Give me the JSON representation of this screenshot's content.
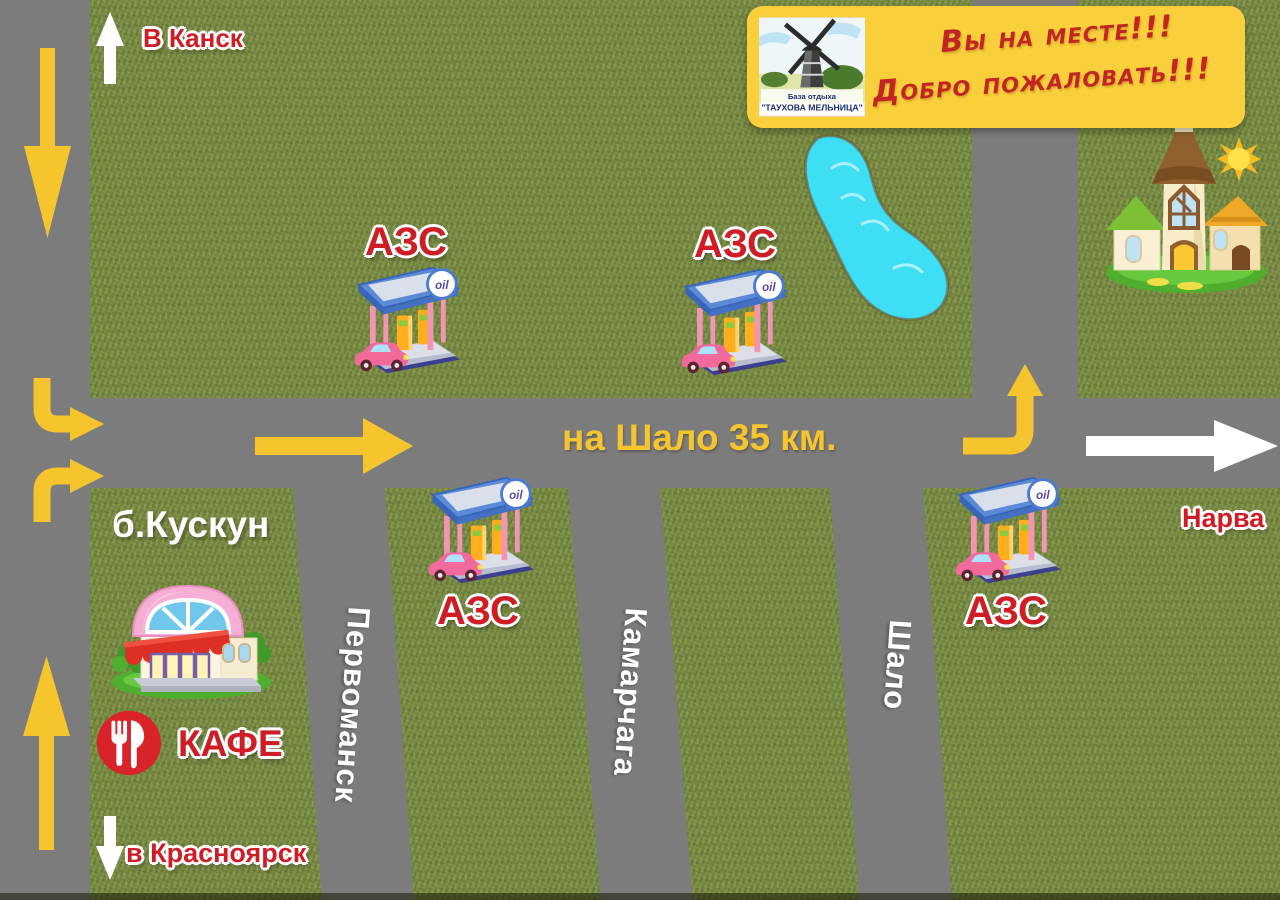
{
  "banner": {
    "line1": "Вы на месте!!!",
    "line2": "Добро пожаловать!!!",
    "logo_caption_top": "База отдыха",
    "logo_caption_bottom": "\"ТАУХОВА МЕЛЬНИЦА\""
  },
  "directions": {
    "north_label": "В Канск",
    "south_label": "в Красноярск",
    "east_route_label": "на Шало 35 км.",
    "east_village_label": "Нарва"
  },
  "places": {
    "village_left": "б.Кускун",
    "cafe_label": "КАФЕ",
    "gas_station_label": "АЗС",
    "oil_sign": "oil"
  },
  "side_roads": [
    {
      "name": "Первоманск"
    },
    {
      "name": "Камарчага"
    },
    {
      "name": "Шало"
    }
  ],
  "colors": {
    "grass": "#7a8c42",
    "road": "#7c7c7c",
    "route_arrow_yellow": "#f6c52e",
    "banner_yellow": "#f9d03b",
    "label_red": "#cf1d25",
    "lake_blue": "#3edef5"
  }
}
